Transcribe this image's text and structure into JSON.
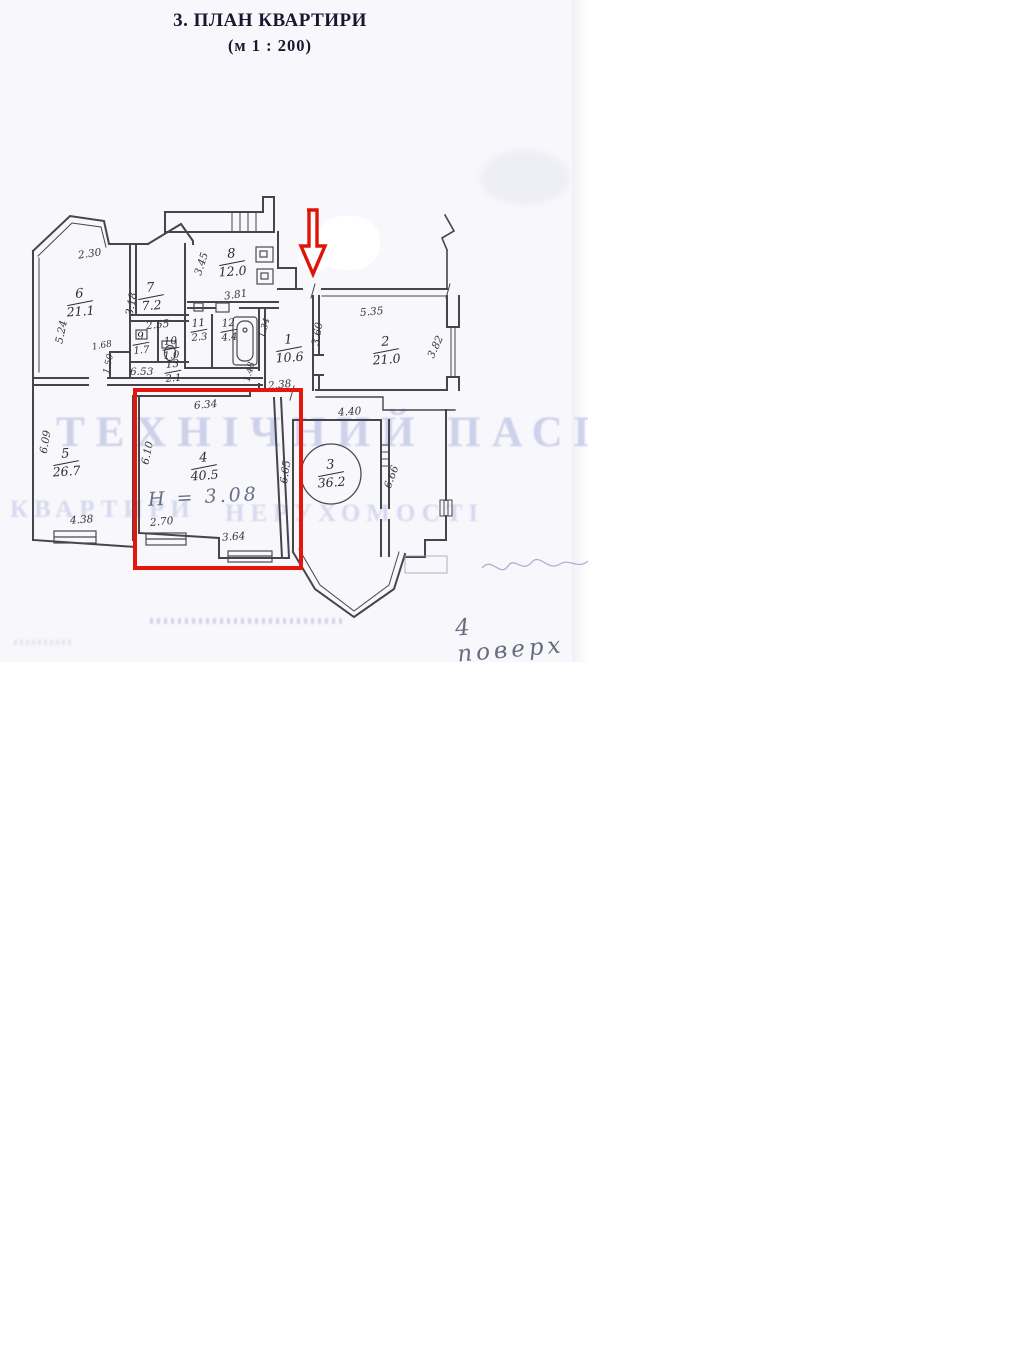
{
  "page": {
    "title": "3. ПЛАН КВАРТИРИ",
    "scale": "(м 1 : 200)"
  },
  "watermark": {
    "line1": "ТЕХНІЧНИЙ ПАСПОРТ",
    "line2_left": "КВАРТИРИ",
    "line2_right": "НЕРУХОМОСТІ"
  },
  "plan": {
    "rooms": [
      {
        "num": "6",
        "area": "21.1"
      },
      {
        "num": "7",
        "area": "7.2"
      },
      {
        "num": "8",
        "area": "12.0"
      },
      {
        "num": "9",
        "area": "1.7"
      },
      {
        "num": "10",
        "area": "1.0"
      },
      {
        "num": "11",
        "area": "2.3"
      },
      {
        "num": "12",
        "area": "4.4"
      },
      {
        "num": "13",
        "area": "2.1"
      },
      {
        "num": "1",
        "area": "10.6"
      },
      {
        "num": "2",
        "area": "21.0"
      },
      {
        "num": "5",
        "area": "26.7"
      },
      {
        "num": "4",
        "area": "40.5"
      },
      {
        "num": "3",
        "area": "36.2"
      }
    ],
    "dims": [
      "2.30",
      "5.24",
      "3.18",
      "2.55",
      "1.68",
      "1.50",
      "6.53",
      "3.45",
      "3.81",
      "5.35",
      "3.60",
      "3.82",
      "1.34",
      "1.48",
      "2.38",
      "4.40",
      "6.34",
      "6.10",
      "6.65",
      "2.70",
      "3.64",
      "4.38",
      "6.09",
      "6.66"
    ],
    "height_note": "Н = 3.08",
    "floor_note": "4 поверх"
  },
  "annotations": {
    "highlight_color": "#e3170d",
    "highlighted_room": "4"
  }
}
